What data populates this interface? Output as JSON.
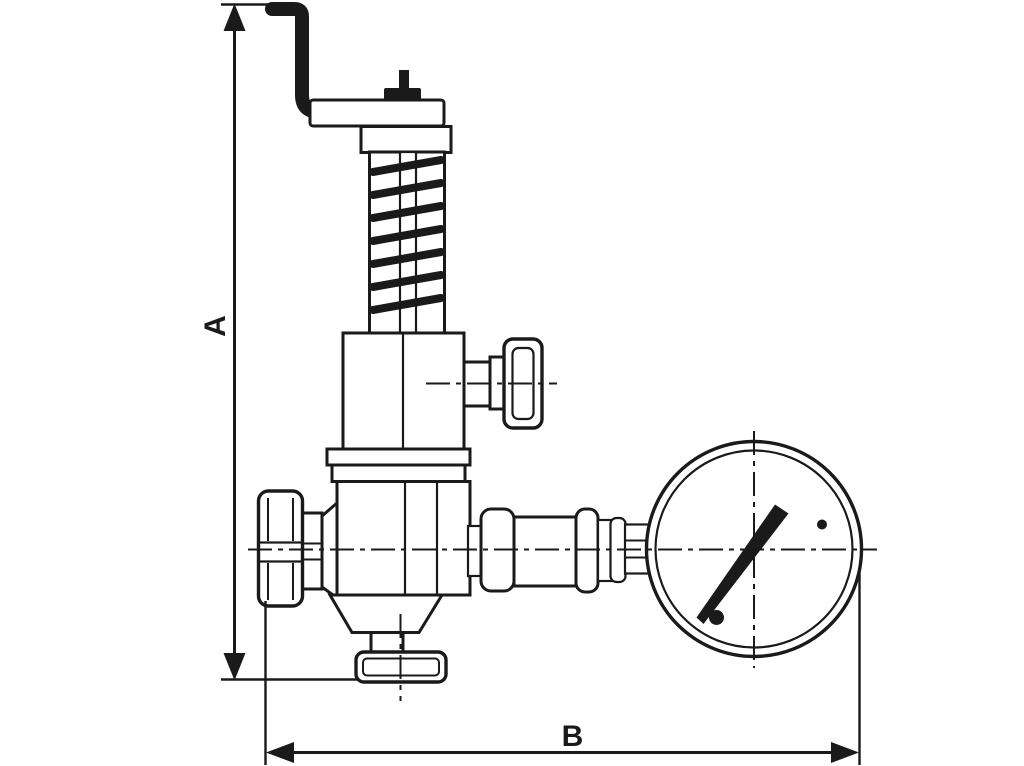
{
  "figure": {
    "kind": "technical-line-drawing",
    "background_color": "#ffffff",
    "line_color": "#1a1a1a",
    "parts": [
      "test-lever",
      "spindle-cap",
      "adjusting-nut",
      "spring-housing",
      "spring-coil",
      "bonnet",
      "side-outlet-cap",
      "bonnet-flange",
      "valve-body",
      "handwheel",
      "inlet-neck",
      "body-cone",
      "base-stem",
      "base-flange",
      "fitting-chain",
      "gauge-socket",
      "pressure-gauge",
      "gauge-needle"
    ]
  },
  "dimensions": {
    "height_label": "A",
    "width_label": "B"
  }
}
